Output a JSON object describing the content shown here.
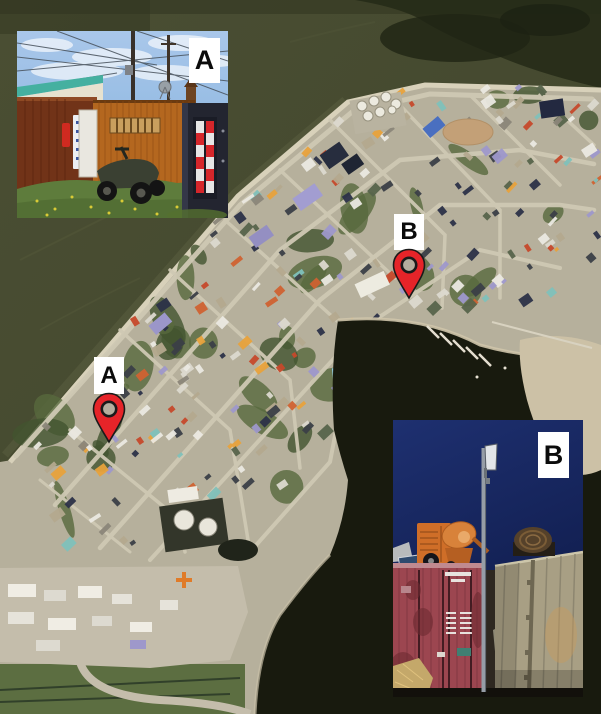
{
  "map": {
    "kind": "satellite-aerial-town",
    "markers": [
      {
        "id": "A",
        "label": "A"
      },
      {
        "id": "B",
        "label": "B"
      }
    ]
  },
  "insets": [
    {
      "id": "A",
      "label": "A",
      "position": "top-left",
      "subject": "ground-photo-daylight-containers-atv"
    },
    {
      "id": "B",
      "label": "B",
      "position": "bottom-right",
      "subject": "ground-photo-dusk-containers-pole"
    }
  ],
  "colors": {
    "pin_red": "#e62429",
    "pin_outline": "#1a1a1a",
    "pin_center": "#b5ae9e",
    "label_bg": "#ffffff",
    "label_text": "#0b0b0b",
    "water_olive": "#474c31",
    "water_dark": "#262b18",
    "harbor_dark": "#181a0e",
    "land_tan": "#b6b09c",
    "road_tan": "#cfc9b4",
    "vegetation": "#57693d",
    "photoA_sky": "#8ab7e2",
    "photoB_sky": "#1e3070"
  }
}
